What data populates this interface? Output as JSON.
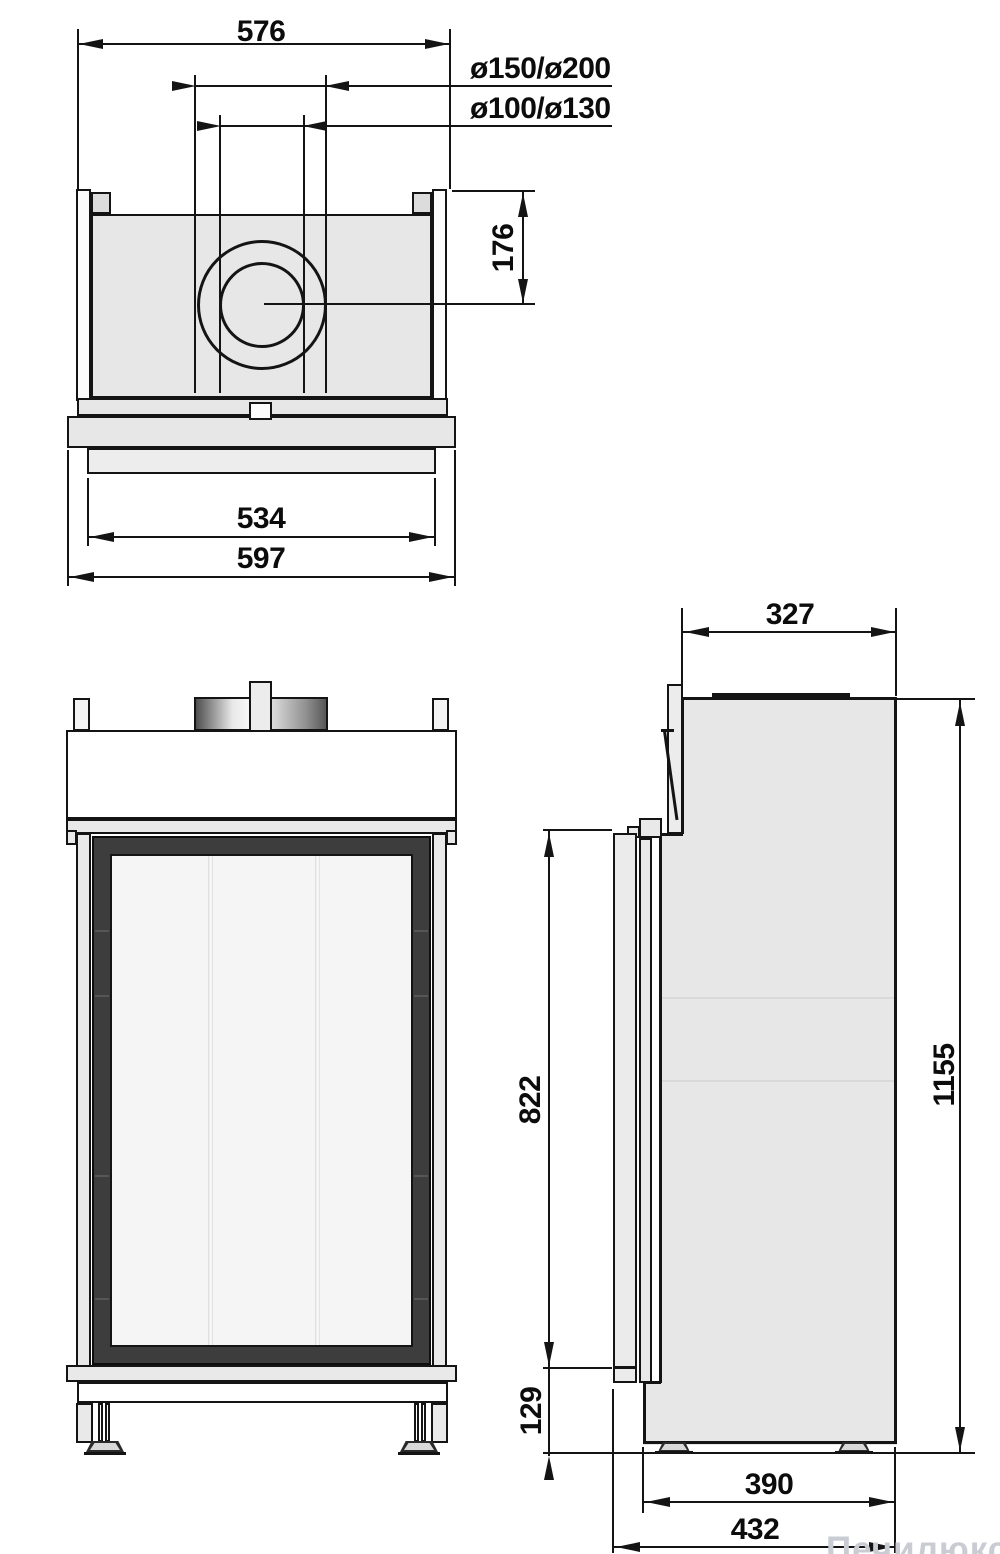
{
  "title": "fireplace-insert-dimension-drawing",
  "dimensions": {
    "top_width": "576",
    "flue_outer": "ø150/ø200",
    "flue_inner": "ø100/ø130",
    "flue_offset": "176",
    "base_inner_width": "534",
    "base_outer_width": "597",
    "top_depth": "327",
    "door_height": "822",
    "total_height": "1155",
    "plinth_height": "129",
    "body_depth": "390",
    "total_depth": "432"
  },
  "watermark": "Печилюкс.ру",
  "colors": {
    "line": "#141414",
    "body_gray": "#e7e7e7",
    "frame_dark": "#3d3d3d",
    "glass": "#f5f5f5"
  }
}
